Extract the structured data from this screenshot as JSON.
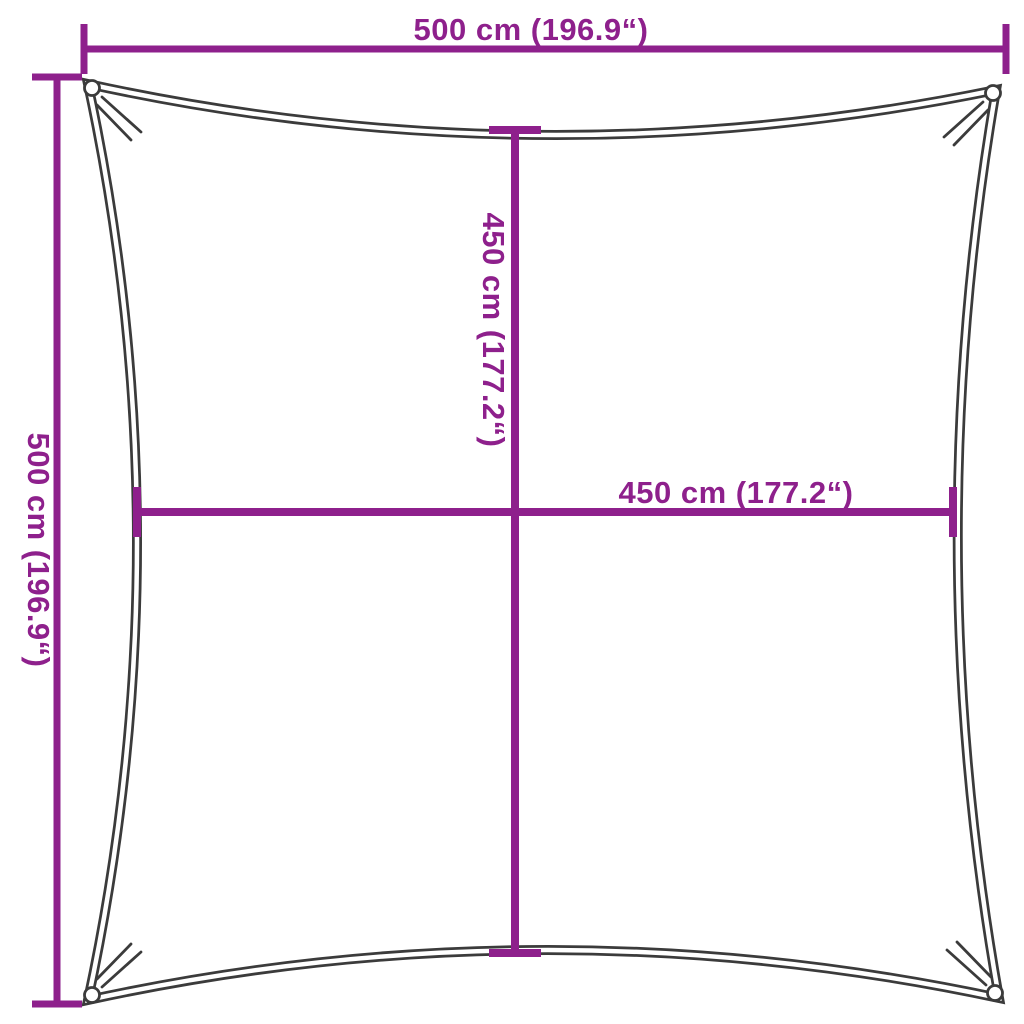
{
  "title": "Square shade sail dimension diagram",
  "colors": {
    "dimension_line": "#8E208C",
    "sail_outline": "#3B3B3B",
    "background": "#FFFFFF"
  },
  "labels": {
    "top": "500 cm (196.9“)",
    "left": "500 cm (196.9“)",
    "inner_vertical": "450 cm (177.2“)",
    "inner_horizontal": "450 cm (177.2“)"
  }
}
